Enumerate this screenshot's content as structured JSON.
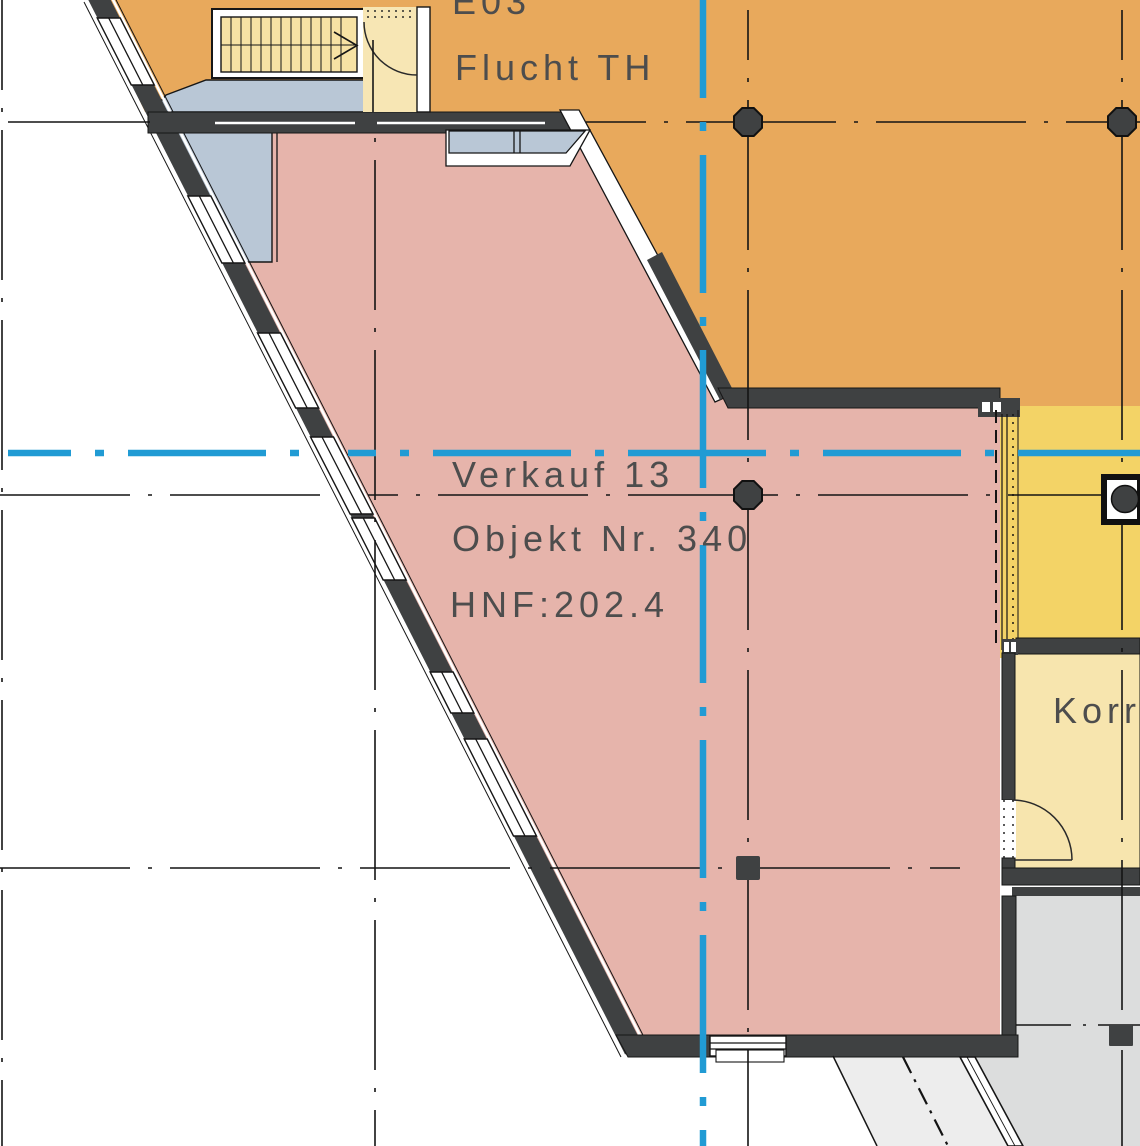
{
  "drawing_type": "architectural floor plan detail",
  "rooms": [
    {
      "id": "flucht-th",
      "code": "E03",
      "name": "Flucht TH"
    },
    {
      "id": "verkauf-13",
      "name": "Verkauf 13",
      "object_no": "Objekt Nr. 340",
      "area": "HNF:202.4"
    },
    {
      "id": "korridor",
      "name": "Korridor"
    }
  ],
  "colors": {
    "room_circulation_orange": "#e8a95c",
    "room_retail_pink": "#e6b4ab",
    "room_service_yellow": "#f3d366",
    "room_corridor_cream": "#f7e5ae",
    "balcony_bluegray": "#b9c7d6",
    "neighbor_gray": "#dcdddd",
    "corridor_light_gray": "#ededed",
    "wall_dark": "#3f4142",
    "axis_cyan": "#219bd4",
    "label_text": "#4d4d4d"
  },
  "symbols": {
    "column_octagon": "structural column (octagon marker)",
    "column_square": "structural column (square marker)",
    "stair": "stair run with up arrow",
    "door_arc": "door swing"
  }
}
